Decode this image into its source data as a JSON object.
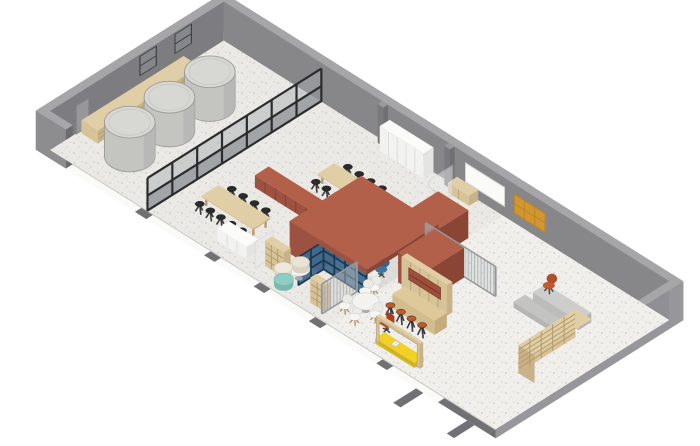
{
  "meta": {
    "title": "Axonometric cutaway interior plan - taproom and studio",
    "visible_text": [],
    "style": "isometric architectural illustration, white background"
  },
  "projection": {
    "ox": 50,
    "oy": 150,
    "bx": 16.25,
    "by": 10.2,
    "ax": 15.25,
    "ay": -9.6,
    "zz": 13
  },
  "room": {
    "length": 27.4,
    "depth": 11.4,
    "wall_height": 3.0,
    "wall_thickness": 0.45,
    "front_stub_length": 1.4
  },
  "palette": {
    "wallInner": "#7d7d81",
    "wallBack": "#87878a",
    "wallRight": "#909094",
    "wallOuter": "#8d8d90",
    "wallTop": "#a6a6a9",
    "wallEndCap": "#6c6c70",
    "wallOuterSliver": "#97979b",
    "floor": "#eae9e5",
    "skirt": "#fafaf9",
    "strip": "#717175",
    "glassFrame": "#2c2c2e",
    "glassLow": "#8f9497",
    "glassHigh": "#a9aeb0",
    "lightGlass": "#e8ebec",
    "lightGlassStroke": "#c2c5c7",
    "blueFrame": "#1f3a50",
    "bluePane": "#3e6b90",
    "meshBase": "#c9cacc",
    "meshFrame": "#96979a",
    "amber": "#d2962f",
    "amberGrid": "#bd8226",
    "yellow": "#f2d024",
    "yellowSide": "#d9ba1d",
    "tankBody": "#c4c5c1",
    "tankTop": "#d7d7d3",
    "tankEdge": "#9c9c98",
    "stoolBlack": "#2b2b2b",
    "stoolOrange": "#c2592c",
    "whiteBoard": "#fafaf9",
    "whiteBoardStroke": "#d5d5d2",
    "doorFill": "#97979a",
    "doorStroke": "#85858a",
    "winFrame": "#3b3b3e",
    "winPane": "#8b8f92",
    "legDark": "#3a3a3c",
    "legWood": "#b59a6d",
    "sets": {
      "wood": {
        "top": "#e0cfa6",
        "front": "#d6c398",
        "side": "#c9b287",
        "dark": "#b59a6d"
      },
      "barwood": {
        "top": "#ddc999",
        "front": "#d3bd8d",
        "side": "#c4ac7c",
        "dark": "#ab9165"
      },
      "white": {
        "top": "#fbfbfa",
        "front": "#f2f2f0",
        "side": "#e4e4e1",
        "dark": "#d8d8d4"
      },
      "terra": {
        "top": "#b2604a",
        "front": "#9d5140",
        "side": "#8a4535",
        "dark": "#7c3d2f",
        "niche": "#a04e3c"
      },
      "desk": {
        "top": "#eeeeec",
        "front": "#e2e2df",
        "side": "#d8d8d5",
        "dark": "#ccccca"
      },
      "grayb": {
        "top": "#c3c4c1",
        "front": "#b5b6b3",
        "side": "#aaaba8",
        "dark": "#9a9b98"
      },
      "grayt": {
        "top": "#cdcecb",
        "front": "#bcbdba",
        "side": "#b2b3b0",
        "dark": "#a2a3a0"
      },
      "pilaster": {
        "top": "#9a9a9c",
        "front": "#7a7a7d",
        "side": "#707073",
        "dark": "#666669"
      }
    }
  },
  "floor": {
    "patches": [
      {
        "b": 17.15,
        "a": 0,
        "db": 10.25,
        "da": 11.4,
        "fill": "#f0efec"
      },
      {
        "b": 14.3,
        "a": 2.7,
        "db": 2.65,
        "da": 4.45,
        "fill": "#dddcd9"
      }
    ],
    "strips": [
      [
        5.65,
        0.7
      ],
      [
        9.9,
        0.65
      ],
      [
        12.95,
        0.65
      ],
      [
        16.35,
        0.7
      ],
      [
        20.5,
        0.65
      ],
      [
        24.3,
        3.1
      ]
    ],
    "tabs": [
      [
        22.95,
        0.45,
        1.5
      ],
      [
        26.1,
        0.45,
        1.35
      ]
    ]
  },
  "objects": [
    {
      "name": "left-wall-door",
      "type": "doorA",
      "a": 1.7,
      "w": 0.8,
      "h": 2.15
    },
    {
      "name": "left-wall-window-1",
      "type": "winA",
      "a": 5.9,
      "w": 1.0,
      "z": 1.45,
      "h": 1.4
    },
    {
      "name": "left-wall-window-2",
      "type": "winA",
      "a": 8.2,
      "w": 1.0,
      "z": 1.45,
      "h": 1.4
    },
    {
      "name": "back-wall-pilaster-1",
      "type": "pilaster",
      "b": 9.75
    },
    {
      "name": "back-wall-pilaster-2",
      "type": "pilaster",
      "b": 13.85
    },
    {
      "name": "back-wall-whiteboard",
      "type": "boardB",
      "b": 14.9,
      "w": 2.4,
      "z": 0.85,
      "h": 1.45
    },
    {
      "name": "back-wall-pinboard",
      "type": "pinboard",
      "b": 17.9,
      "w": 1.9,
      "z": 0.8,
      "h": 1.45
    },
    {
      "name": "wall-shelf-low",
      "type": "boxo",
      "b": 0.15,
      "a": 1.9,
      "z": 0,
      "db": 1.0,
      "da": 6.7,
      "dz": 1.0,
      "c": "wood",
      "sideH": 2,
      "sideV": 6
    },
    {
      "name": "fermentation-tank-3",
      "type": "tank",
      "b": 2.75,
      "a": 7.55,
      "r": 1.15,
      "h": 2.6
    },
    {
      "name": "fermentation-tank-2",
      "type": "tank",
      "b": 2.75,
      "a": 4.9,
      "r": 1.15,
      "h": 2.6
    },
    {
      "name": "fermentation-tank-1",
      "type": "tank",
      "b": 2.75,
      "a": 2.3,
      "r": 1.15,
      "h": 2.6
    },
    {
      "name": "tank-room-glass-partition",
      "type": "gridwallA",
      "b": 6.0,
      "a": 0,
      "len": 11.4,
      "h": 2.55,
      "bays": 7,
      "railZ": 1.2
    },
    {
      "name": "white-cabinet-run",
      "type": "boxo",
      "b": 10.2,
      "a": 10.75,
      "z": 0,
      "db": 2.7,
      "da": 0.65,
      "dz": 1.9,
      "c": "white",
      "frontSeams": 5
    },
    {
      "name": "wood-sideboard",
      "type": "boxo",
      "b": 14.35,
      "a": 10.8,
      "z": 0,
      "db": 1.3,
      "da": 0.6,
      "dz": 0.78,
      "c": "wood",
      "frontSeams": 2
    },
    {
      "name": "stool-row-table1-back",
      "type": "stools",
      "pts": [
        [
          10.4,
          8.45
        ],
        [
          11.1,
          8.45
        ],
        [
          11.8,
          8.45
        ],
        [
          12.5,
          8.45
        ]
      ],
      "h": 0.62,
      "c": "#2b2b2b"
    },
    {
      "name": "communal-table-1",
      "type": "table",
      "b": 9.9,
      "a": 7.0,
      "db": 3.2,
      "da": 1.1,
      "h": 0.78
    },
    {
      "name": "stool-row-table1-front",
      "type": "stools",
      "pts": [
        [
          10.15,
          6.62
        ],
        [
          10.8,
          6.62
        ],
        [
          11.45,
          6.62
        ],
        [
          12.1,
          6.62
        ],
        [
          12.75,
          6.62
        ]
      ],
      "h": 0.62,
      "c": "#2b2b2b"
    },
    {
      "name": "terracotta-counter",
      "type": "boxo",
      "b": 8.15,
      "a": 4.75,
      "z": 0,
      "db": 4.4,
      "da": 0.9,
      "dz": 0.95,
      "c": "terra",
      "frontSeams": 7
    },
    {
      "name": "corridor-glass-screen",
      "type": "corridorGlass"
    },
    {
      "name": "terracotta-wing-back",
      "type": "boxo",
      "b": 15.35,
      "a": 7.15,
      "z": 0,
      "db": 1.85,
      "da": 1.95,
      "dz": 2.15,
      "c": "terra"
    },
    {
      "name": "stool-row-table2-back",
      "type": "stools",
      "pts": [
        [
          7.9,
          3.5
        ],
        [
          8.6,
          3.5
        ],
        [
          9.3,
          3.5
        ],
        [
          10.0,
          3.5
        ]
      ],
      "h": 0.62,
      "c": "#2b2b2b"
    },
    {
      "name": "communal-table-2",
      "type": "table",
      "b": 7.4,
      "a": 2.05,
      "db": 3.2,
      "da": 1.1,
      "h": 0.78
    },
    {
      "name": "stool-row-table2-front",
      "type": "stools",
      "pts": [
        [
          7.65,
          1.67
        ],
        [
          8.3,
          1.67
        ],
        [
          8.95,
          1.67
        ],
        [
          9.6,
          1.67
        ],
        [
          10.25,
          1.67
        ]
      ],
      "h": 0.62,
      "c": "#2b2b2b"
    },
    {
      "name": "white-credenza",
      "type": "boxo",
      "b": 9.6,
      "a": 0.75,
      "z": 0,
      "db": 1.8,
      "da": 0.75,
      "dz": 0.95,
      "c": "white",
      "frontSeams": 3
    },
    {
      "name": "meeting-room-solid-wall",
      "type": "boxo",
      "b": 12.45,
      "a": 2.45,
      "z": 0,
      "db": 1.75,
      "da": 4.7,
      "dz": 2.5,
      "c": "terra"
    },
    {
      "name": "meeting-room-glazing-side",
      "type": "bluewallA",
      "b": 14.3,
      "a": 1.05,
      "len": 1.65,
      "h": 2.2,
      "bays": 2
    },
    {
      "name": "meeting-desk",
      "type": "boxo",
      "b": 15.05,
      "a": 3.3,
      "z": 0,
      "db": 1.75,
      "da": 0.65,
      "dz": 0.74,
      "c": "desk"
    },
    {
      "name": "monitor-1",
      "type": "monitor",
      "b": 15.45,
      "a": 3.62
    },
    {
      "name": "monitor-2",
      "type": "monitor",
      "b": 16.15,
      "a": 3.62
    },
    {
      "name": "white-stool-meeting",
      "type": "pouf",
      "b": 14.75,
      "a": 5.2,
      "r": 0.3,
      "h": 0.45,
      "c": "#f2f2f0",
      "s": "#d8d8d4"
    },
    {
      "name": "office-chair-blue-1",
      "type": "chair",
      "b": 15.55,
      "a": 4.4,
      "c1": "#3f74a0",
      "c2": "#35658d",
      "legs": "stem"
    },
    {
      "name": "office-chair-blue-2",
      "type": "chair",
      "b": 16.35,
      "a": 4.3,
      "c1": "#3f74a0",
      "c2": "#35658d",
      "legs": "stem"
    },
    {
      "name": "meeting-room-glazing-front",
      "type": "bluewallB",
      "b": 14.3,
      "a": 2.7,
      "len": 2.65,
      "h": 2.2,
      "bays": 4
    },
    {
      "name": "terracotta-roof",
      "type": "boxo",
      "b": 12.45,
      "a": 2.45,
      "z": 2.1,
      "db": 4.75,
      "da": 4.7,
      "dz": 0.4,
      "c": "terra"
    },
    {
      "name": "mesh-screen-back",
      "type": "screenB",
      "b": 16.6,
      "a": 6.95,
      "len": 4.3,
      "h": 2.3
    },
    {
      "name": "terracotta-wing-right",
      "type": "boxo",
      "b": 17.2,
      "a": 4.5,
      "z": 0,
      "db": 1.8,
      "da": 2.4,
      "dz": 2.3,
      "c": "terra"
    },
    {
      "name": "bar-niche-wall",
      "type": "nicheWall",
      "b": 17.55,
      "a": 4.35,
      "len": 2.8,
      "h": 2.35
    },
    {
      "name": "bar-counter",
      "type": "boxo",
      "b": 18.3,
      "a": 2.95,
      "z": 0,
      "db": 2.6,
      "da": 0.8,
      "dz": 1.1,
      "c": "barwood"
    },
    {
      "name": "bar-stool-row",
      "type": "stools",
      "pts": [
        [
          18.6,
          2.5
        ],
        [
          19.25,
          2.5
        ],
        [
          19.9,
          2.5
        ],
        [
          20.55,
          2.5
        ]
      ],
      "h": 0.8,
      "c": "#c2592c"
    },
    {
      "name": "nook-glass-pane",
      "type": "vplaneA",
      "b": 12.1,
      "a": 0.55,
      "len": 1.2,
      "h": 2.0
    },
    {
      "name": "cubby-shelf-1",
      "type": "cubby",
      "b": 12.3,
      "a": 1.0,
      "db": 1.15,
      "da": 0.45,
      "h": 1.95,
      "cols": 3,
      "rows": 4
    },
    {
      "name": "side-table-round",
      "type": "roundTable",
      "b": 13.95,
      "a": 1.45,
      "r": 0.5,
      "h": 0.72,
      "top": "#f4f4f2"
    },
    {
      "name": "pouf-cream-1",
      "type": "pouf",
      "b": 13.5,
      "a": 2.05,
      "r": 0.4,
      "h": 0.45,
      "c": "#e9e3d5",
      "s": "#d9d2c2"
    },
    {
      "name": "pouf-cream-2",
      "type": "pouf",
      "b": 13.22,
      "a": 1.2,
      "r": 0.4,
      "h": 0.42,
      "c": "#eee9dc",
      "s": "#dcd6c8"
    },
    {
      "name": "pouf-teal",
      "type": "pouf",
      "b": 13.8,
      "a": 0.62,
      "r": 0.44,
      "h": 0.42,
      "c": "#8ecdc4",
      "s": "#79b9b0"
    },
    {
      "name": "cubby-shelf-2",
      "type": "cubby",
      "b": 15.5,
      "a": 0.55,
      "db": 0.85,
      "da": 0.4,
      "h": 1.95,
      "cols": 2,
      "rows": 4
    },
    {
      "name": "mesh-screen-front",
      "type": "screenA",
      "b": 16.4,
      "a": 0.35,
      "len": 2.3,
      "h": 2.3
    },
    {
      "name": "cafe-chair-5",
      "type": "chair",
      "b": 17.0,
      "a": 3.1,
      "c1": "#f5f5f3",
      "c2": "#eceae6",
      "legs": "wood"
    },
    {
      "name": "cafe-chair-1",
      "type": "chair",
      "b": 16.9,
      "a": 2.65,
      "c1": "#f5f5f3",
      "c2": "#eceae6",
      "legs": "wood"
    },
    {
      "name": "cafe-chair-2",
      "type": "chair",
      "b": 17.0,
      "a": 1.2,
      "c1": "#f5f5f3",
      "c2": "#eceae6",
      "legs": "wood"
    },
    {
      "name": "cafe-chair-3",
      "type": "chair",
      "b": 17.85,
      "a": 0.95,
      "c1": "#f5f5f3",
      "c2": "#eceae6",
      "legs": "wood"
    },
    {
      "name": "cafe-round-table",
      "type": "roundTable",
      "b": 17.6,
      "a": 1.95,
      "r": 0.62,
      "h": 0.73,
      "top": "#f2f2ef"
    },
    {
      "name": "cafe-chair-4",
      "type": "chair",
      "b": 18.35,
      "a": 1.75,
      "c1": "#f5f5f3",
      "c2": "#eceae6",
      "legs": "wood"
    },
    {
      "name": "lounge-bench",
      "type": "boxo",
      "b": 22.0,
      "a": 6.95,
      "z": 0,
      "db": 2.6,
      "da": 0.75,
      "dz": 0.45,
      "c": "grayb"
    },
    {
      "name": "lounge-table",
      "type": "boxo",
      "b": 22.3,
      "a": 7.9,
      "z": 0,
      "db": 2.8,
      "da": 0.85,
      "dz": 0.72,
      "c": "grayt"
    },
    {
      "name": "lounge-chair-orange",
      "type": "chair",
      "b": 22.3,
      "a": 8.95,
      "c1": "#c25a2d",
      "c2": "#b14f26",
      "legs": "dark"
    },
    {
      "name": "lounge-bookshelf",
      "type": "loungeShelf",
      "b": 25.35,
      "a": 3.7,
      "db": 1.0,
      "da": 3.75,
      "h": 2.15,
      "cols": 5,
      "rows": 6
    },
    {
      "name": "office-chair-red",
      "type": "redChair",
      "b": 19.2,
      "a": 1.6
    },
    {
      "name": "window-seat-frame",
      "type": "portal",
      "b": 19.4,
      "a": 0.72,
      "len": 2.7,
      "h": 1.9,
      "th": 0.18
    }
  ]
}
